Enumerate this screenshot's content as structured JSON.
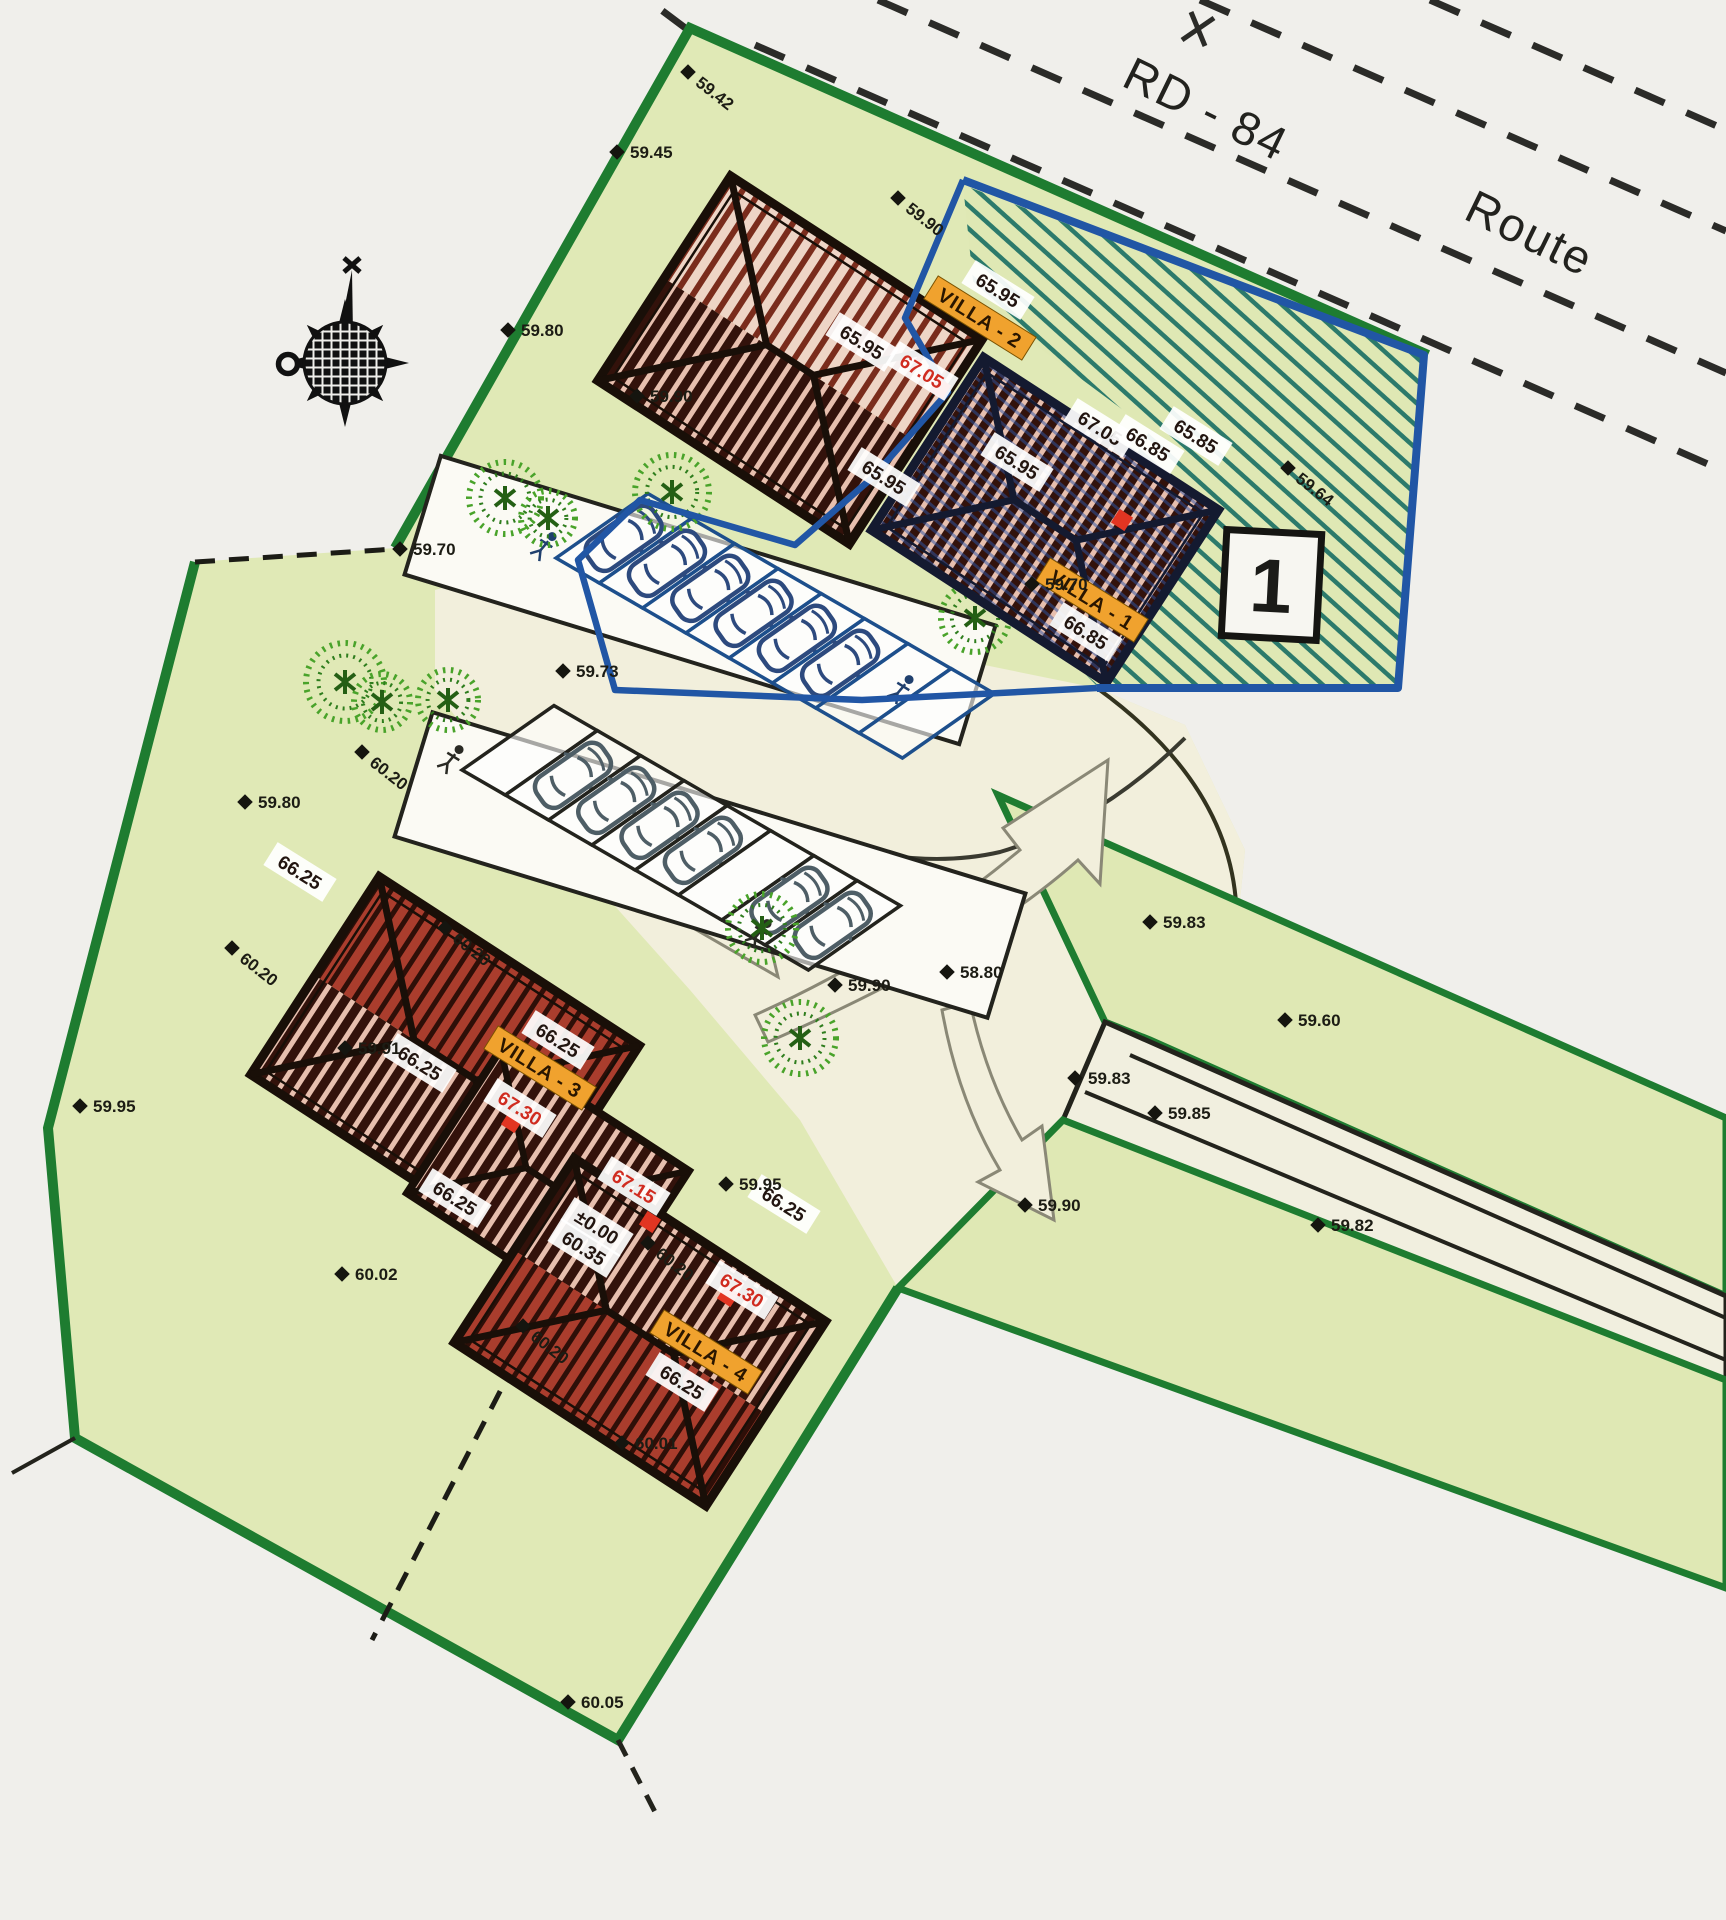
{
  "road": {
    "name": "RD - 84",
    "type": "Route"
  },
  "lot": {
    "number": "1"
  },
  "colors": {
    "parcel_green": "#e0e9b6",
    "border_green": "#1e7c30",
    "lot_blue": "#2156a5",
    "hatch_teal": "#2c7a6b",
    "roof_dark": "#33120b",
    "roof_brick": "#aa3d2d",
    "roof_light": "#eed5c6",
    "label_orange": "#f0a22e",
    "label_red": "#d02c20",
    "court_cream": "#f2efdc"
  },
  "villas": [
    {
      "name": "VILLA - 1"
    },
    {
      "name": "VILLA - 2"
    },
    {
      "name": "VILLA - 3"
    },
    {
      "name": "VILLA - 4"
    }
  ],
  "roof_labels": [
    {
      "text": "65.95",
      "x": 998,
      "y": 290,
      "kind": "white"
    },
    {
      "text": "VILLA - 2",
      "x": 980,
      "y": 318,
      "kind": "villa"
    },
    {
      "text": "65.95",
      "x": 862,
      "y": 342,
      "kind": "white"
    },
    {
      "text": "67.05",
      "x": 922,
      "y": 371,
      "kind": "red"
    },
    {
      "text": "65.95",
      "x": 884,
      "y": 477,
      "kind": "white"
    },
    {
      "text": "65.95",
      "x": 1017,
      "y": 462,
      "kind": "white"
    },
    {
      "text": "67.05",
      "x": 1100,
      "y": 428,
      "kind": "white"
    },
    {
      "text": "66.85",
      "x": 1148,
      "y": 444,
      "kind": "white"
    },
    {
      "text": "65.85",
      "x": 1196,
      "y": 436,
      "kind": "white"
    },
    {
      "text": "VILLA - 1",
      "x": 1092,
      "y": 600,
      "kind": "villa"
    },
    {
      "text": "66.85",
      "x": 1086,
      "y": 632,
      "kind": "white"
    },
    {
      "text": "66.25",
      "x": 300,
      "y": 872,
      "kind": "white"
    },
    {
      "text": "66.25",
      "x": 420,
      "y": 1063,
      "kind": "white"
    },
    {
      "text": "66.25",
      "x": 558,
      "y": 1040,
      "kind": "white"
    },
    {
      "text": "VILLA - 3",
      "x": 540,
      "y": 1068,
      "kind": "villa"
    },
    {
      "text": "67.30",
      "x": 520,
      "y": 1108,
      "kind": "red"
    },
    {
      "text": "66.25",
      "x": 455,
      "y": 1198,
      "kind": "white"
    },
    {
      "text": "67.15",
      "x": 634,
      "y": 1186,
      "kind": "red"
    },
    {
      "text": "±0.00",
      "x": 597,
      "y": 1227,
      "kind": "white"
    },
    {
      "text": "60.35",
      "x": 584,
      "y": 1248,
      "kind": "white"
    },
    {
      "text": "66.25",
      "x": 784,
      "y": 1204,
      "kind": "white"
    },
    {
      "text": "67.30",
      "x": 742,
      "y": 1290,
      "kind": "red"
    },
    {
      "text": "VILLA - 4",
      "x": 706,
      "y": 1352,
      "kind": "villa"
    },
    {
      "text": "66.25",
      "x": 682,
      "y": 1382,
      "kind": "white"
    }
  ],
  "spot_elevations": [
    {
      "v": "59.42",
      "x": 688,
      "y": 72,
      "r": 38
    },
    {
      "v": "59.45",
      "x": 617,
      "y": 152,
      "r": 0
    },
    {
      "v": "59.90",
      "x": 898,
      "y": 198,
      "r": 38
    },
    {
      "v": "59.80",
      "x": 508,
      "y": 330,
      "r": 0
    },
    {
      "v": "59.90",
      "x": 637,
      "y": 396,
      "r": 0
    },
    {
      "v": "59.64",
      "x": 1288,
      "y": 468,
      "r": 38
    },
    {
      "v": "59.70",
      "x": 400,
      "y": 549,
      "r": 0
    },
    {
      "v": "59.73",
      "x": 563,
      "y": 671,
      "r": 0
    },
    {
      "v": "59.70",
      "x": 1032,
      "y": 584,
      "r": 0
    },
    {
      "v": "59.80",
      "x": 245,
      "y": 802,
      "r": 0
    },
    {
      "v": "60.20",
      "x": 362,
      "y": 752,
      "r": 38
    },
    {
      "v": "60.20",
      "x": 232,
      "y": 948,
      "r": 38
    },
    {
      "v": "60.20",
      "x": 445,
      "y": 928,
      "r": 38
    },
    {
      "v": "59.91",
      "x": 345,
      "y": 1048,
      "r": 0
    },
    {
      "v": "59.95",
      "x": 80,
      "y": 1106,
      "r": 0
    },
    {
      "v": "59.90",
      "x": 835,
      "y": 985,
      "r": 0
    },
    {
      "v": "58.80",
      "x": 947,
      "y": 972,
      "r": 0
    },
    {
      "v": "59.83",
      "x": 1150,
      "y": 922,
      "r": 0
    },
    {
      "v": "59.85",
      "x": 1155,
      "y": 1113,
      "r": 0
    },
    {
      "v": "59.90",
      "x": 1025,
      "y": 1205,
      "r": 0
    },
    {
      "v": "59.95",
      "x": 726,
      "y": 1184,
      "r": 0
    },
    {
      "v": "60.20",
      "x": 648,
      "y": 1243,
      "r": 38
    },
    {
      "v": "60.20",
      "x": 523,
      "y": 1326,
      "r": 38
    },
    {
      "v": "60.02",
      "x": 342,
      "y": 1274,
      "r": 0
    },
    {
      "v": "60.01",
      "x": 622,
      "y": 1443,
      "r": 0
    },
    {
      "v": "60.05",
      "x": 568,
      "y": 1702,
      "r": 0
    },
    {
      "v": "59.60",
      "x": 1285,
      "y": 1020,
      "r": 0
    },
    {
      "v": "59.83",
      "x": 1075,
      "y": 1078,
      "r": 0
    },
    {
      "v": "59.82",
      "x": 1318,
      "y": 1225,
      "r": 0
    }
  ],
  "ridge_markers": [
    {
      "x": 940,
      "y": 388
    },
    {
      "x": 1122,
      "y": 520
    },
    {
      "x": 512,
      "y": 1122
    },
    {
      "x": 650,
      "y": 1222
    },
    {
      "x": 728,
      "y": 1296
    }
  ]
}
